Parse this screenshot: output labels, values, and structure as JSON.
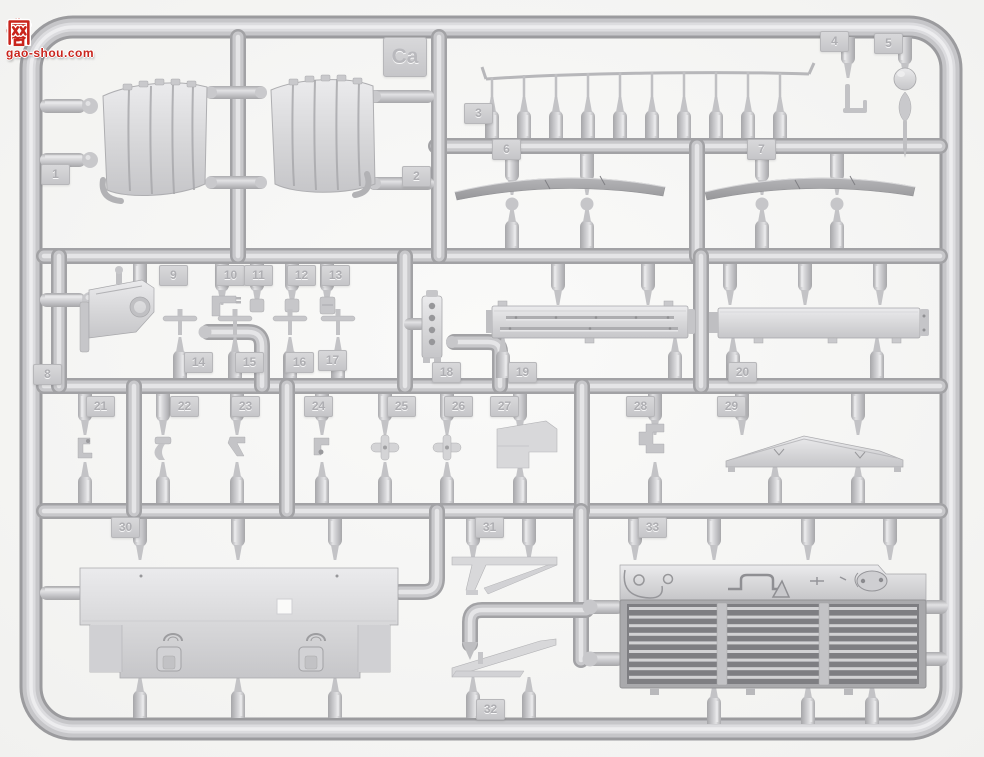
{
  "image_kind": "photo of an injection-molded plastic model kit sprue (light grey styrene)",
  "watermark": {
    "char_left": "高",
    "char_right": "网",
    "site": "gao-shou.com",
    "red": "#c9241c"
  },
  "sprue": {
    "frame_label": "Ca",
    "plastic_base_color": "#c8c8cb",
    "plastic_highlight": "#ebebed",
    "plastic_shadow": "#a0a0a3",
    "dark_part_color": "#9e9ea2",
    "grille_dark_color": "#7e7e82",
    "background_color": "#f6f6f5",
    "tags": [
      "1",
      "2",
      "3",
      "4",
      "5",
      "6",
      "7",
      "8",
      "9",
      "10",
      "11",
      "12",
      "13",
      "14",
      "15",
      "16",
      "17",
      "18",
      "19",
      "20",
      "21",
      "22",
      "23",
      "24",
      "25",
      "26",
      "27",
      "28",
      "29",
      "30",
      "31",
      "32",
      "33"
    ]
  }
}
